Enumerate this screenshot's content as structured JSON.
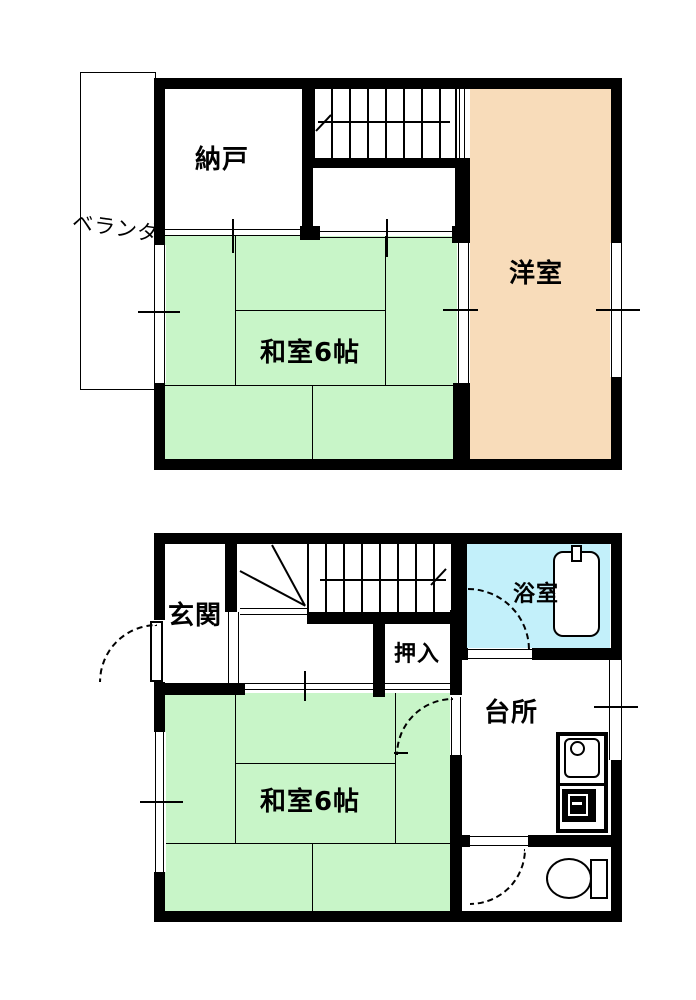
{
  "floor_plan": {
    "floors": {
      "f2": {
        "storage": "納戸",
        "balcony": "ベランダ",
        "japanese_room": "和室6帖",
        "western_room": "洋室"
      },
      "f1": {
        "entrance": "玄関",
        "closet": "押入",
        "bath": "浴室",
        "kitchen": "台所",
        "japanese_room": "和室6帖"
      }
    },
    "colors": {
      "tatami_green": "#c8f5c8",
      "western_room_peach": "#f8dcba",
      "bath_cyan": "#c3f0fa",
      "wall_black": "#000000",
      "background": "#ffffff"
    }
  }
}
